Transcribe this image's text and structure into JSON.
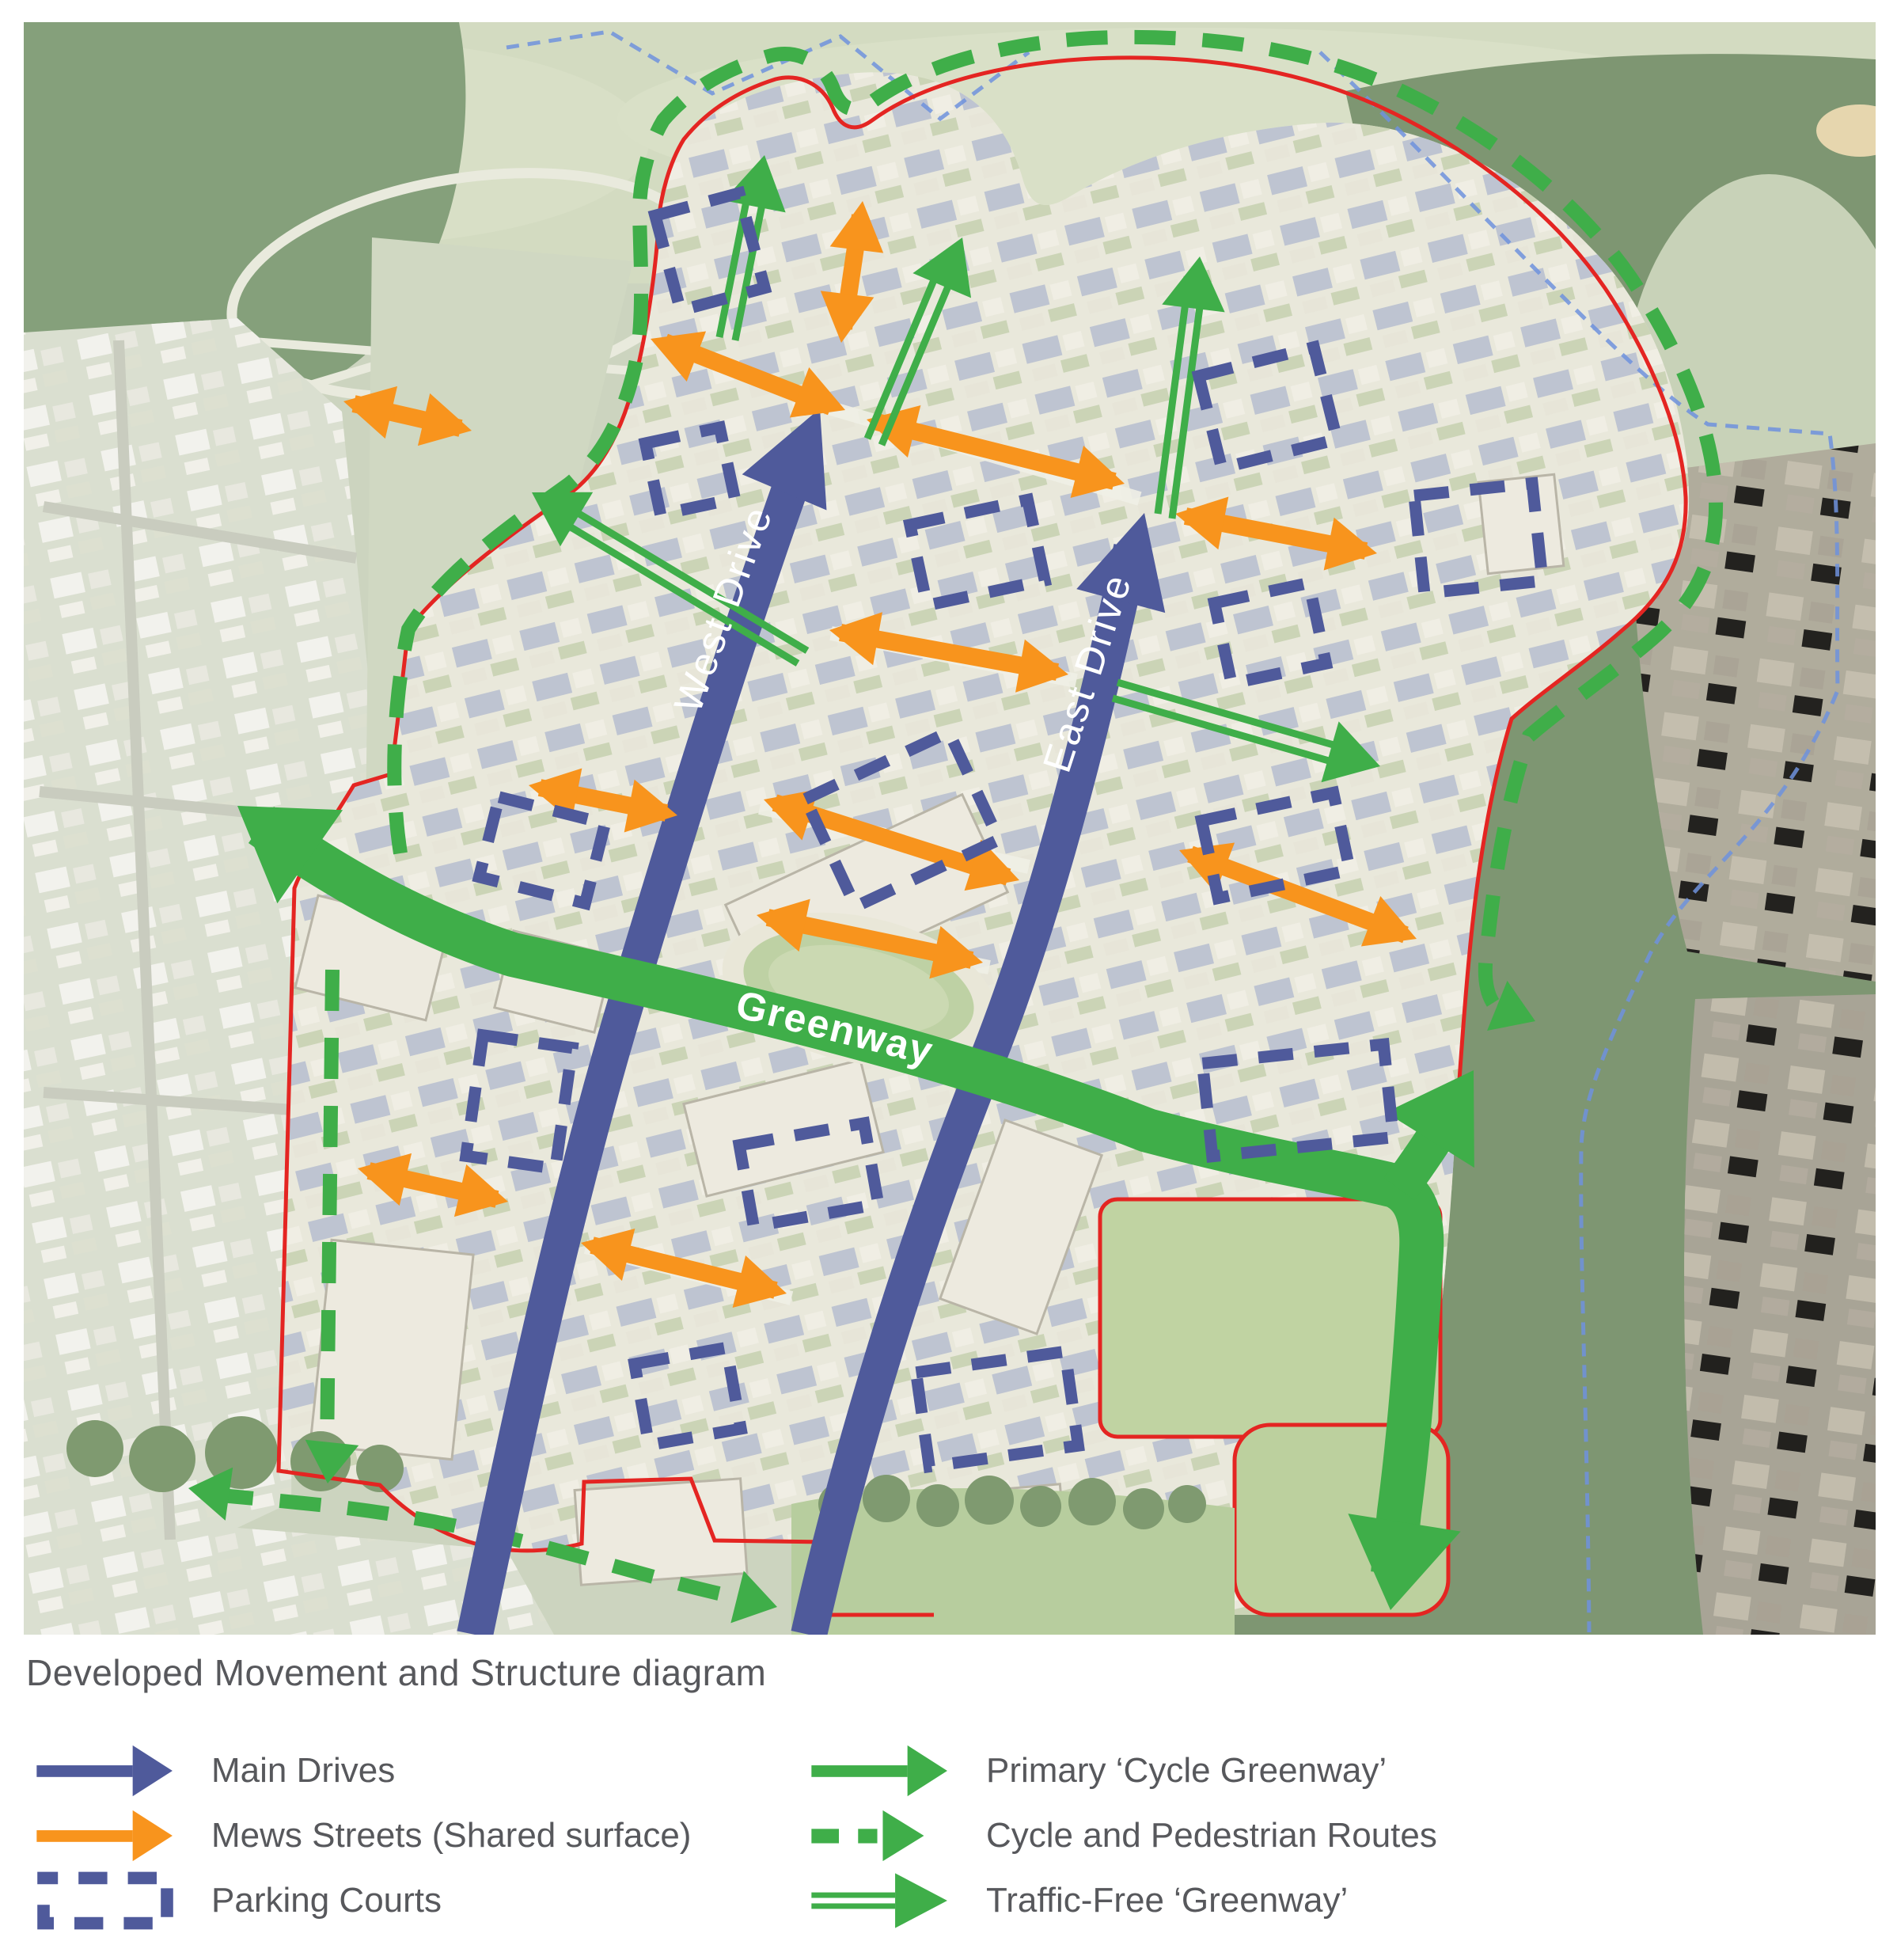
{
  "figure": {
    "caption": "Developed Movement and Structure diagram"
  },
  "map": {
    "road_labels": {
      "west_drive": "West Drive",
      "east_drive": "East Drive",
      "greenway": "Greenway"
    },
    "colors": {
      "main_drives": "#4f5a9b",
      "mews_streets": "#f8941d",
      "greenway_routes": "#3fae49",
      "site_boundary_line": "#e42522",
      "context_boundary_line": "#6f92dd"
    }
  },
  "legend": {
    "left": [
      {
        "icon": "main-drive-arrow-icon",
        "label": "Main Drives"
      },
      {
        "icon": "mews-street-arrow-icon",
        "label": "Mews Streets (Shared surface)"
      },
      {
        "icon": "parking-court-icon",
        "label": "Parking Courts"
      }
    ],
    "right": [
      {
        "icon": "cycle-greenway-arrow-icon",
        "label": "Primary ‘Cycle Greenway’"
      },
      {
        "icon": "cycle-pedestrian-route-icon",
        "label": "Cycle and Pedestrian Routes"
      },
      {
        "icon": "traffic-free-greenway-icon",
        "label": "Traffic-Free ‘Greenway’"
      }
    ]
  }
}
